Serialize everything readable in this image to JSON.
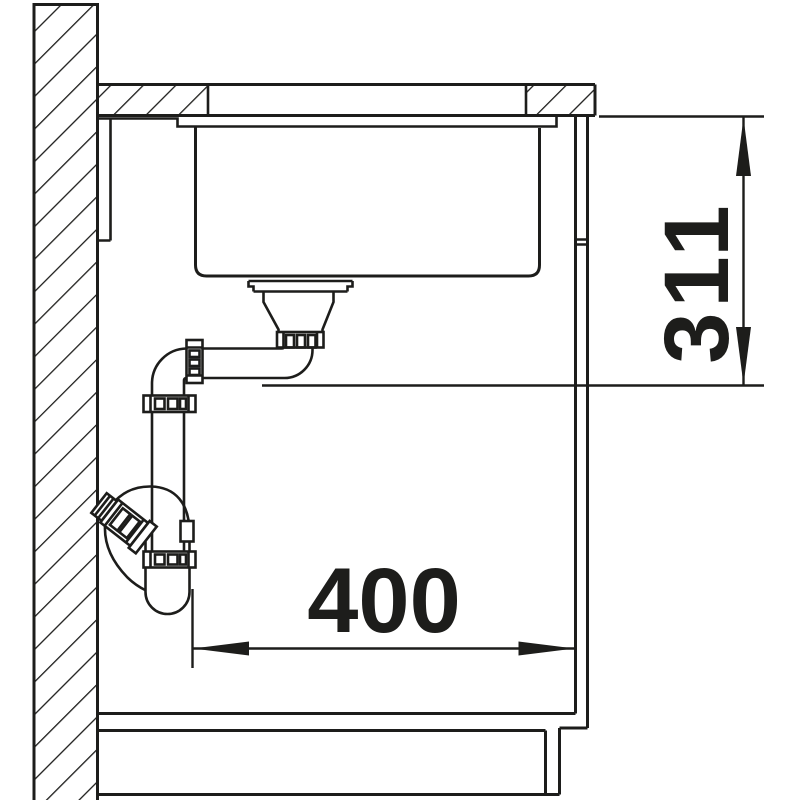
{
  "page": {
    "background": "#ffffff",
    "line_color": "#1d1d1b",
    "type": "technical-section-drawing"
  },
  "dimensions": {
    "height": {
      "value": "311",
      "orientation": "vertical"
    },
    "width": {
      "value": "400",
      "orientation": "horizontal"
    }
  }
}
